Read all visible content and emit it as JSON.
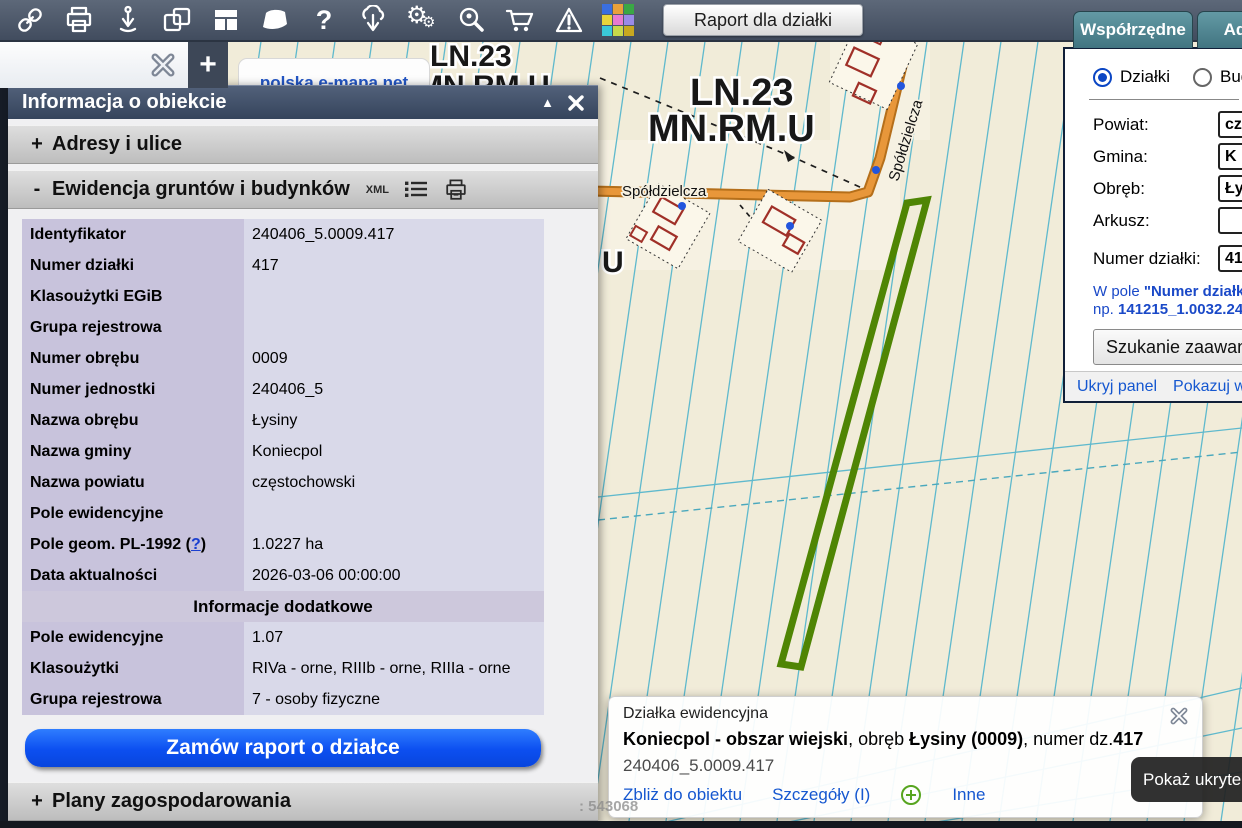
{
  "toolbar": {
    "report_button": "Raport dla działki",
    "icons": [
      "link",
      "print",
      "pin-download",
      "copy",
      "layout",
      "polygon",
      "help",
      "cloud-download",
      "settings",
      "search-location",
      "cart",
      "warning",
      "palette"
    ],
    "help_glyph": "?",
    "palette_colors": [
      "#3a6fe0",
      "#e8a13a",
      "#3aa845",
      "#e8d53a",
      "#e87ad0",
      "#9a8ae8",
      "#3ac8d8",
      "#c8d84a",
      "#c8a820"
    ]
  },
  "tabstrip": {
    "add": "+"
  },
  "logo": "polska e-mapa.net",
  "map": {
    "zone_line1": "LN.23",
    "zone_line2": "MN.RM.U",
    "zone2_line1": "LN.23",
    "zone2_line2": "MN.RM.U",
    "street_h": "Spółdzielcza",
    "street_v": "Spółdzielcza",
    "label_u": "U",
    "coord_text": ": 543068",
    "highlight_color": "#4f8504",
    "road_color": "#dd8a2b",
    "parcel_line_color": "#5fb9cd"
  },
  "info_panel": {
    "title": "Informacja o obiekcie",
    "collapse_icon": "▲",
    "plus": "+",
    "minus": "-",
    "section_adresy": "Adresy i ulice",
    "section_egib": "Ewidencja gruntów i budynków",
    "section_plany": "Plany zagospodarowania",
    "xml_badge": "XML",
    "table": {
      "rows": [
        {
          "label": "Identyfikator",
          "value": "240406_5.0009.417"
        },
        {
          "label": "Numer działki",
          "value": "417"
        },
        {
          "label": "Klasoużytki EGiB",
          "value": ""
        },
        {
          "label": "Grupa rejestrowa",
          "value": ""
        },
        {
          "label": "Numer obrębu",
          "value": "0009"
        },
        {
          "label": "Numer jednostki",
          "value": "240406_5"
        },
        {
          "label": "Nazwa obrębu",
          "value": "Łysiny"
        },
        {
          "label": "Nazwa gminy",
          "value": "Koniecpol"
        },
        {
          "label": "Nazwa powiatu",
          "value": "częstochowski"
        },
        {
          "label": "Pole ewidencyjne",
          "value": ""
        },
        {
          "label_prefix": "Pole geom. PL-1992 (",
          "help_link": "?",
          "label_suffix": ")",
          "value": "1.0227 ha"
        },
        {
          "label": "Data aktualności",
          "value": "2026-03-06 00:00:00"
        }
      ],
      "subheader": "Informacje dodatkowe",
      "rows2": [
        {
          "label": "Pole ewidencyjne",
          "value": "1.07"
        },
        {
          "label": "Klasoużytki",
          "value": "RIVa - orne, RIIIb - orne, RIIIa - orne"
        },
        {
          "label": "Grupa rejestrowa",
          "value": "7 - osoby fizyczne"
        }
      ]
    },
    "order_button": "Zamów raport o działce"
  },
  "search_panel": {
    "tab_coords": "Współrzędne",
    "tab_address": "Adre",
    "radio_parcels": "Działki",
    "radio_buildings": "Bud",
    "fields": [
      {
        "label": "Powiat:",
        "value": "cz"
      },
      {
        "label": "Gmina:",
        "value": "K"
      },
      {
        "label": "Obręb:",
        "value": "Ły"
      },
      {
        "label": "Arkusz:",
        "value": ""
      },
      {
        "label": "Numer działki:",
        "value": "41"
      }
    ],
    "help_line1_a": "W pole ",
    "help_line1_b": "\"Numer działki\"",
    "help_line2_a": "np. ",
    "help_line2_b": "141215_1.0032.24",
    "advanced_button": "Szukanie zaawans",
    "link_hide": "Ukryj panel",
    "link_show": "Pokazuj w"
  },
  "popup": {
    "type_label": "Działka ewidencyjna",
    "title_bold1": "Koniecpol - obszar wiejski",
    "title_mid1": ", obręb ",
    "title_bold2": "Łysiny (0009)",
    "title_mid2": ", numer dz.",
    "title_bold3": "417",
    "object_id": "240406_5.0009.417",
    "link_zoom": "Zbliż do obiektu",
    "link_details": "Szczegóły (I)",
    "link_other": "Inne"
  },
  "tooltip": {
    "text": "Pokaż ukryte"
  }
}
